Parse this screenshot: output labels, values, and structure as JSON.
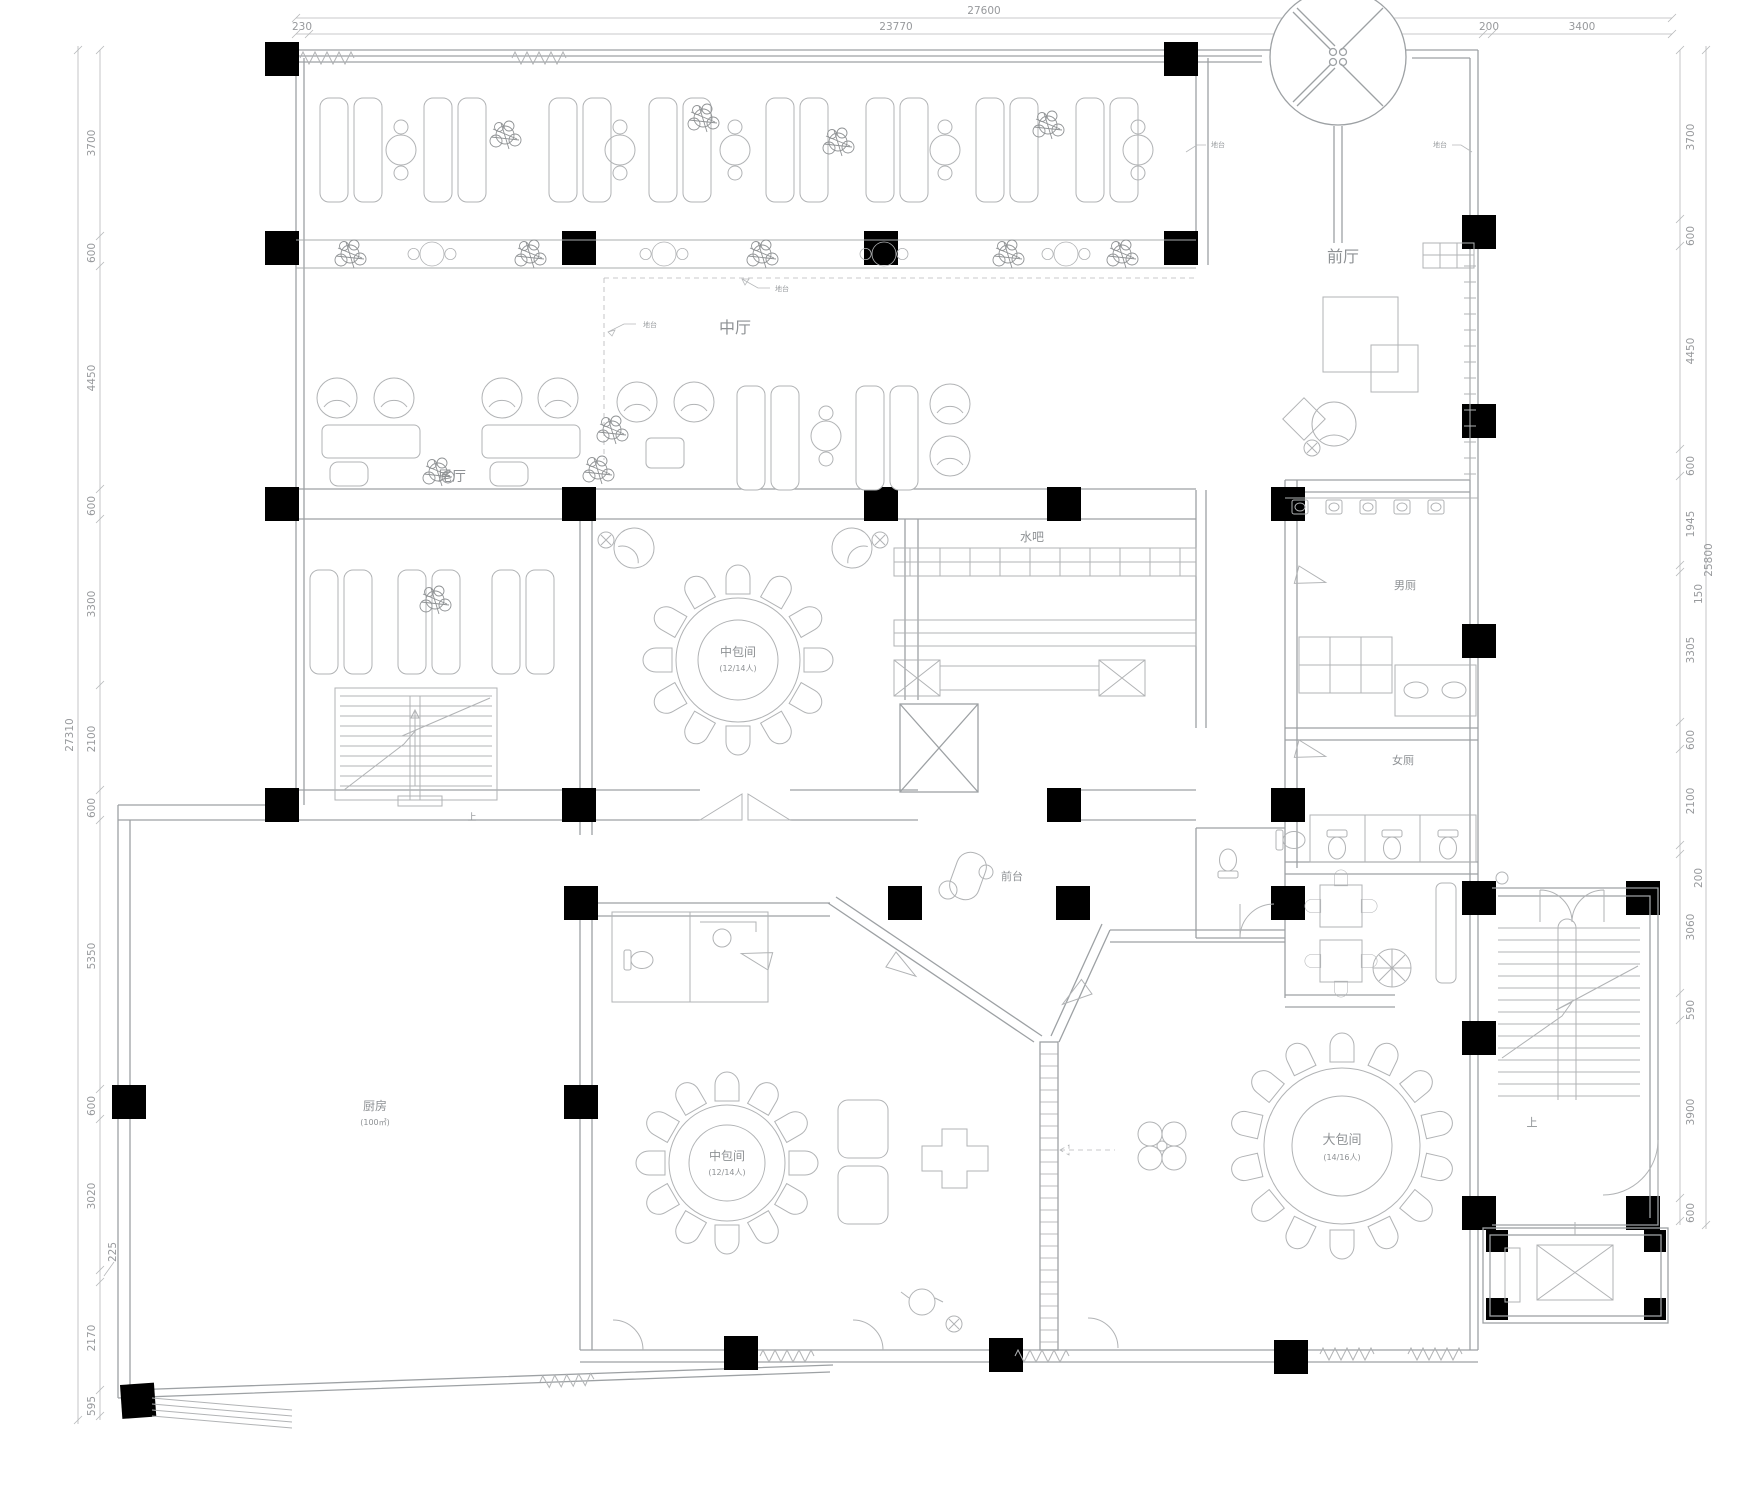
{
  "rooms": {
    "front_hall": "前厅",
    "middle_hall": "中厅",
    "tail_hall": "尾厅",
    "water_bar": "水吧",
    "mens_restroom": "男厕",
    "womens_restroom": "女厕",
    "front_desk": "前台",
    "kitchen": {
      "name": "厨房",
      "area": "(100㎡)"
    },
    "medium_private_room_upper": {
      "name": "中包间",
      "capacity": "(12/14人)"
    },
    "medium_private_room_lower": {
      "name": "中包间",
      "capacity": "(12/14人)"
    },
    "large_private_room": {
      "name": "大包间",
      "capacity": "(14/16人)"
    }
  },
  "annotations": {
    "platform_note_a": "地台",
    "platform_note_b": "地台",
    "platform_note_c": "地台",
    "platform_note_d": "地台",
    "stairs_up_left": "上",
    "stairs_up_right": "上"
  },
  "dimensions": {
    "top": {
      "overall": "27600",
      "offset_left": "230",
      "span_main": "23770",
      "offset_right": "200",
      "span_wing": "3400"
    },
    "left": {
      "overall": "27310",
      "segments": [
        "3700",
        "600",
        "4450",
        "600",
        "3300",
        "2100",
        "600",
        "5350",
        "600",
        "3020",
        "225",
        "2170",
        "595"
      ]
    },
    "right": {
      "overall": "25800",
      "segments": [
        "3700",
        "600",
        "4450",
        "600",
        "1945",
        "150",
        "3305",
        "600",
        "2100",
        "200",
        "3060",
        "590",
        "3900",
        "600"
      ]
    }
  }
}
